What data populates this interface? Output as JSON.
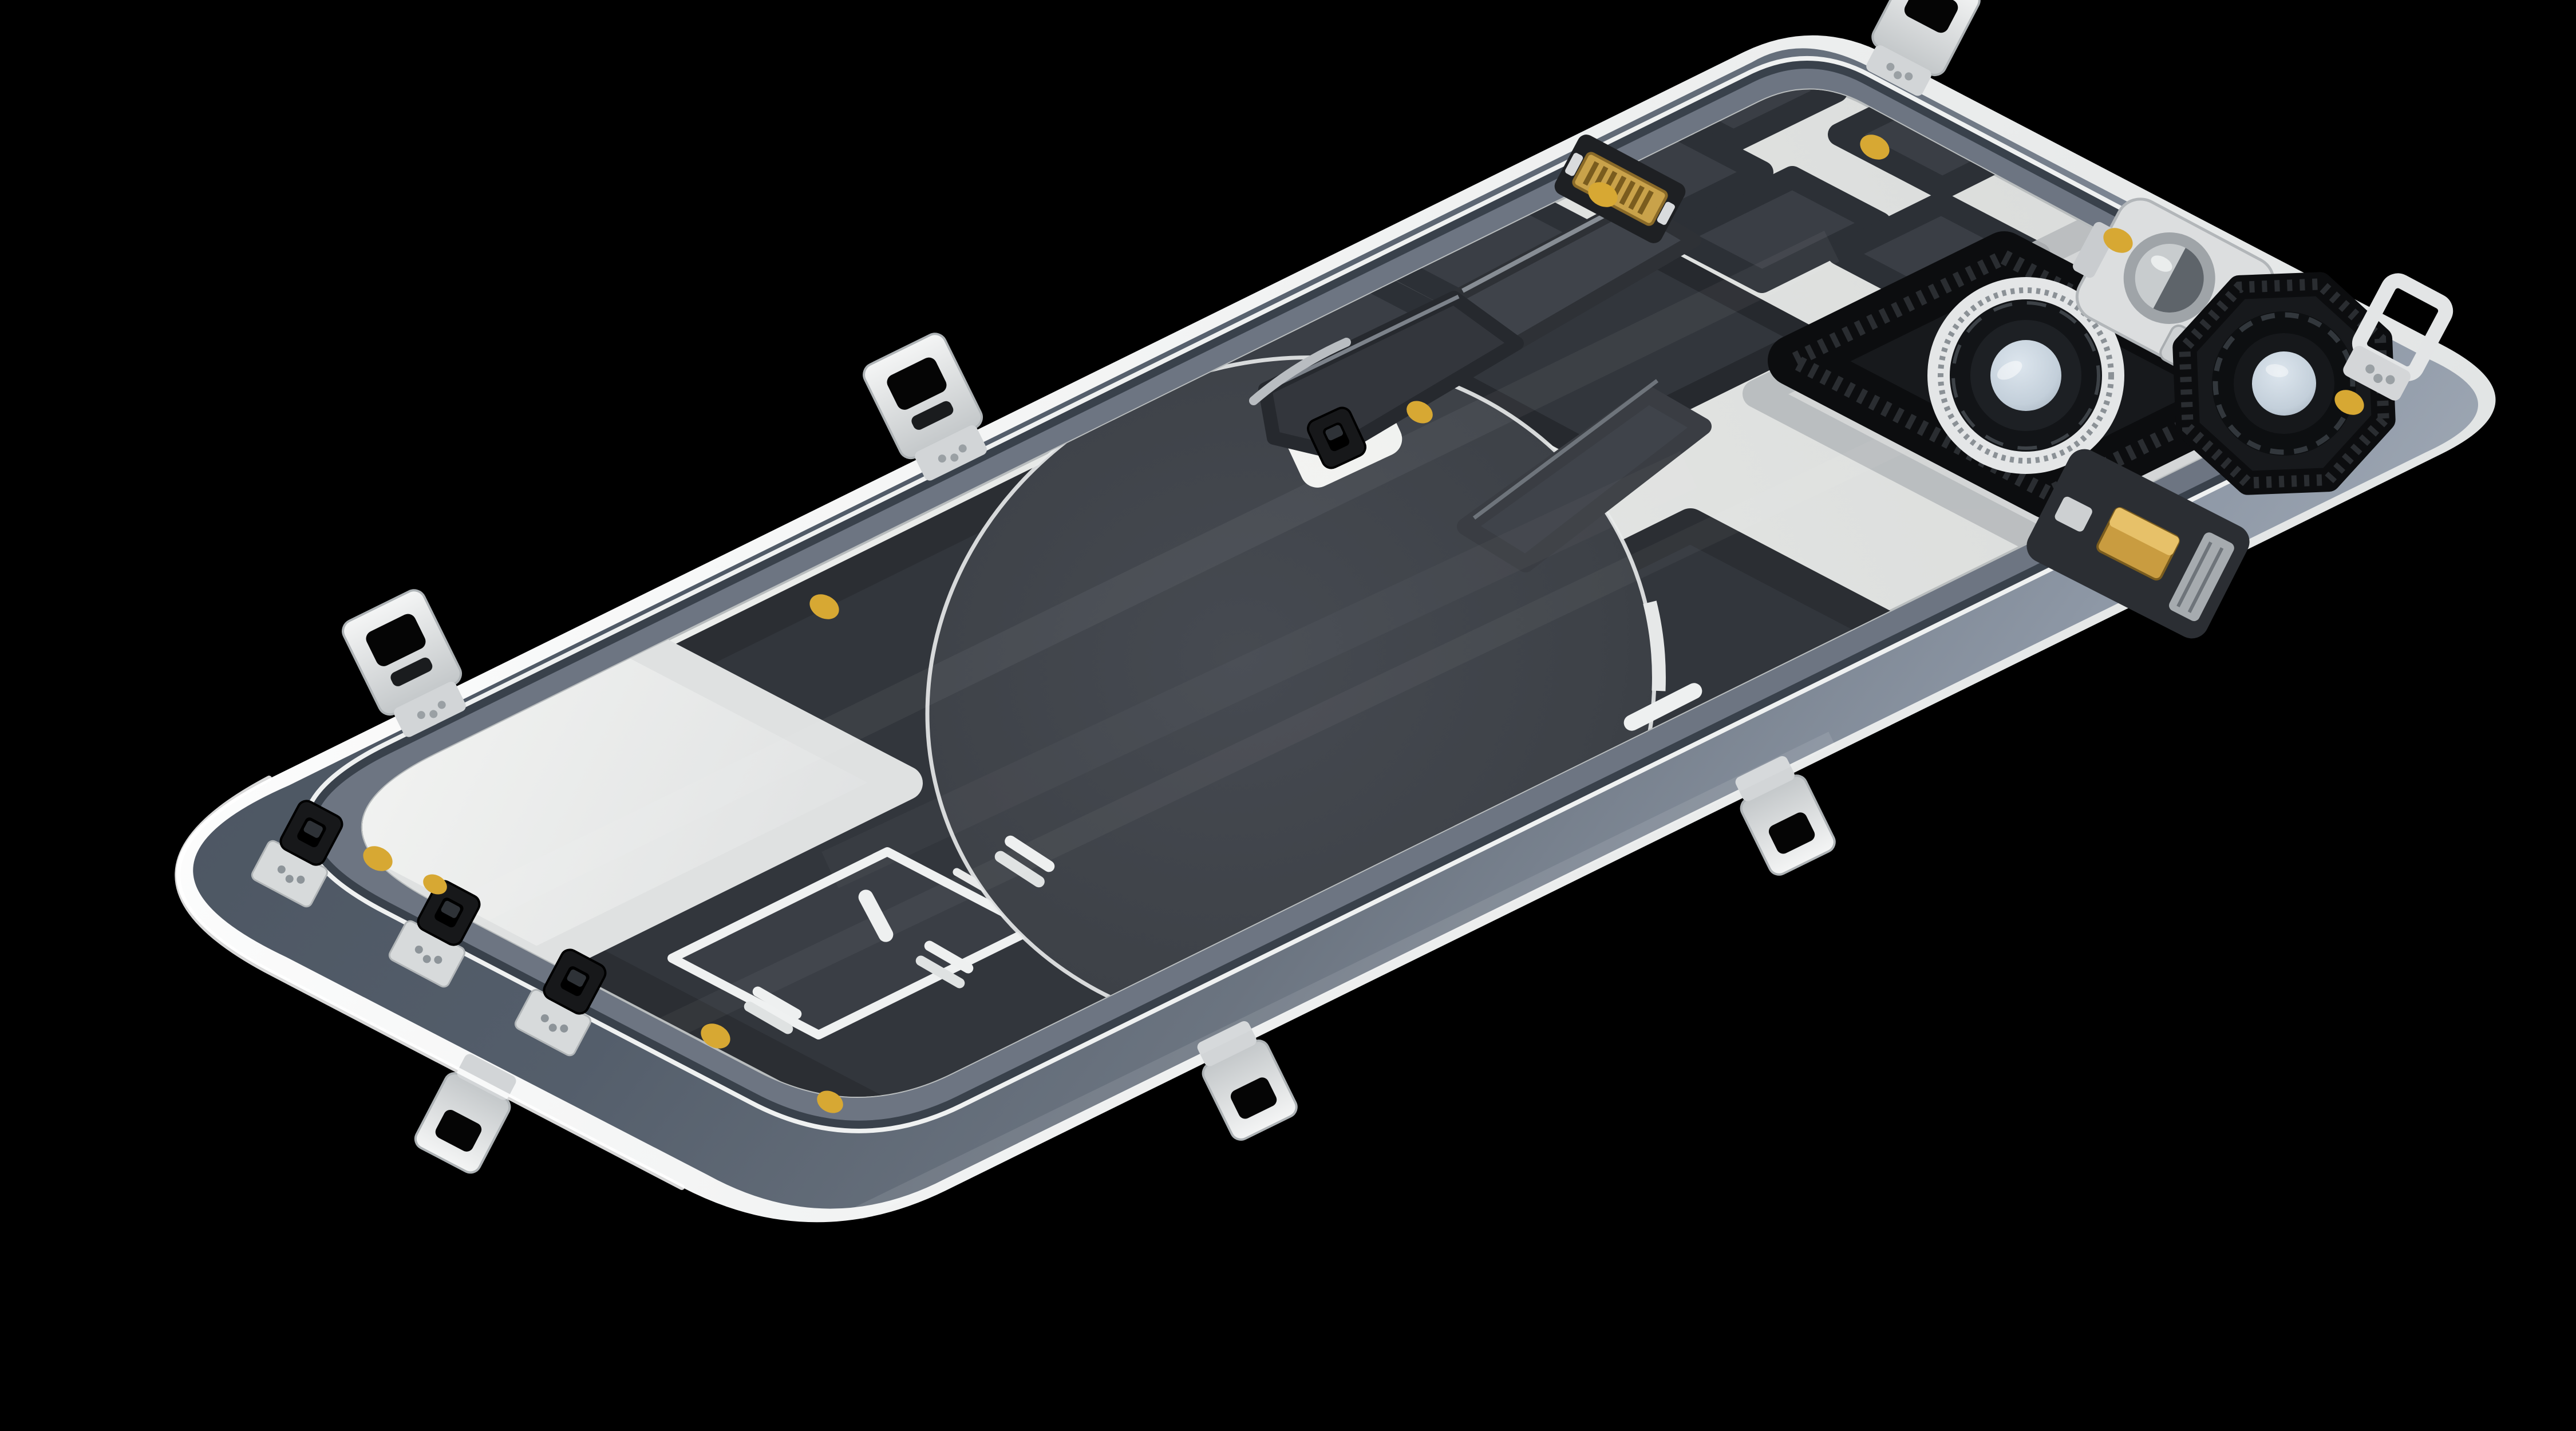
{
  "scene": {
    "title": "Smartphone rear glass panel - interior view",
    "description": "Macro studio photograph of an iPhone rear cover (back glass) seen from the inside, lying diagonally on a black background. The interior shows a bright silver EMI shield plate, dark graphite thermal pads, the round wireless-charging coil disc, two camera lens openings with black foam gaskets, a flash bracket with screw, a gold board-to-board flex connector, gold adhesive dots and several metal spring clips around the rim.",
    "background": "#000000"
  },
  "colors": {
    "background": "#000000",
    "glass_rim": "#f4f6f4",
    "band_mid": "#6d7582",
    "band_edge_dark": "#39414b",
    "plate_silver": "#e7e9e7",
    "tongue_silver": "#eff0ee",
    "graphite_pad": "#3a3e45",
    "graphite_deep": "#32363c",
    "coil_disc": "#3f434a",
    "coil_outline": "#e9ebeb",
    "slot_bright": "#eef0f0",
    "box_line": "#eff1f1",
    "gasket_black": "#17191c",
    "lens_flange": "#e4e6e7",
    "lens_barrel": "#121417",
    "lens_glass": "#c9d4de",
    "flash_plate": "#dcdedf",
    "gold_connector": "#c9a24a",
    "mic_gold": "#c99c40",
    "adhesive_dot": "#d7a833",
    "clip_silver": "#e3e5e6",
    "black_clip": "#17181a",
    "flex_dark": "#33363c",
    "flex_mid": "#3f434a",
    "camera_recess": "#d3d5d6"
  },
  "parts": {
    "panel": "rear glass panel interior",
    "rim": "polished glass rim",
    "border_band": "slate painted glass border",
    "shield_plate": "silver shield plate",
    "graphite": "graphite thermal pads",
    "coil": "wireless charging coil disc",
    "coil_tail": "coil flex tail",
    "flex": "folded antenna flex ribbon",
    "connector": "board-to-board connector",
    "wide_camera": "wide camera lens opening",
    "tele_camera": "second camera lens opening",
    "flash": "flash bracket and window",
    "screw": "phillips screw",
    "microphone": "rear microphone",
    "spring_clips": "edge spring clips",
    "snap_clips": "black snap clips",
    "dots": "gold adhesive dots",
    "slots": "antenna slot windows",
    "speaker_box": "outlined service window"
  },
  "counts": {
    "spring_clips": 6,
    "snap_clips": 3,
    "adhesive_dots": 10,
    "camera_openings": 2
  }
}
